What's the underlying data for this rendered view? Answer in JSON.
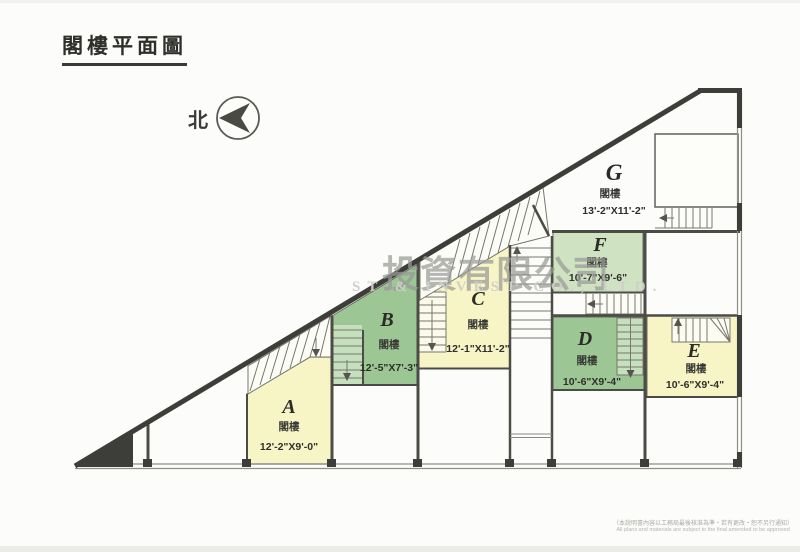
{
  "page": {
    "title": "閣樓平面圖"
  },
  "north_indicator": {
    "label": "北"
  },
  "watermark": {
    "cjk": "投資有限公司",
    "latin": "ST & INVEST CO., LTD."
  },
  "units": [
    {
      "letter": "A",
      "floor_label": "閣樓",
      "dimensions": "12'-2\"X9'-0\""
    },
    {
      "letter": "B",
      "floor_label": "閣樓",
      "dimensions": "12'-5\"X7'-3\""
    },
    {
      "letter": "C",
      "floor_label": "閣樓",
      "dimensions": "12'-1\"X11'-2\""
    },
    {
      "letter": "D",
      "floor_label": "閣樓",
      "dimensions": "10'-6\"X9'-4\""
    },
    {
      "letter": "E",
      "floor_label": "閣樓",
      "dimensions": "10'-6\"X9'-4\""
    },
    {
      "letter": "F",
      "floor_label": "閣樓",
      "dimensions": "10'-7\"X9'-6\""
    },
    {
      "letter": "G",
      "floor_label": "閣樓",
      "dimensions": "13'-2\"X11'-2\""
    }
  ],
  "footnote": {
    "cjk": "（本說明書內容以工務局最後核准為準・若有更改・恕不另行通知）",
    "en": "All plans and materials are subject to the final amended to be approved"
  },
  "colors": {
    "room_yellow": "#f7f5c6",
    "room_green": "#9cc794",
    "room_light_green": "#cfe3c2",
    "wall_dark": "#3d3d3a",
    "line_gray": "#777770"
  }
}
